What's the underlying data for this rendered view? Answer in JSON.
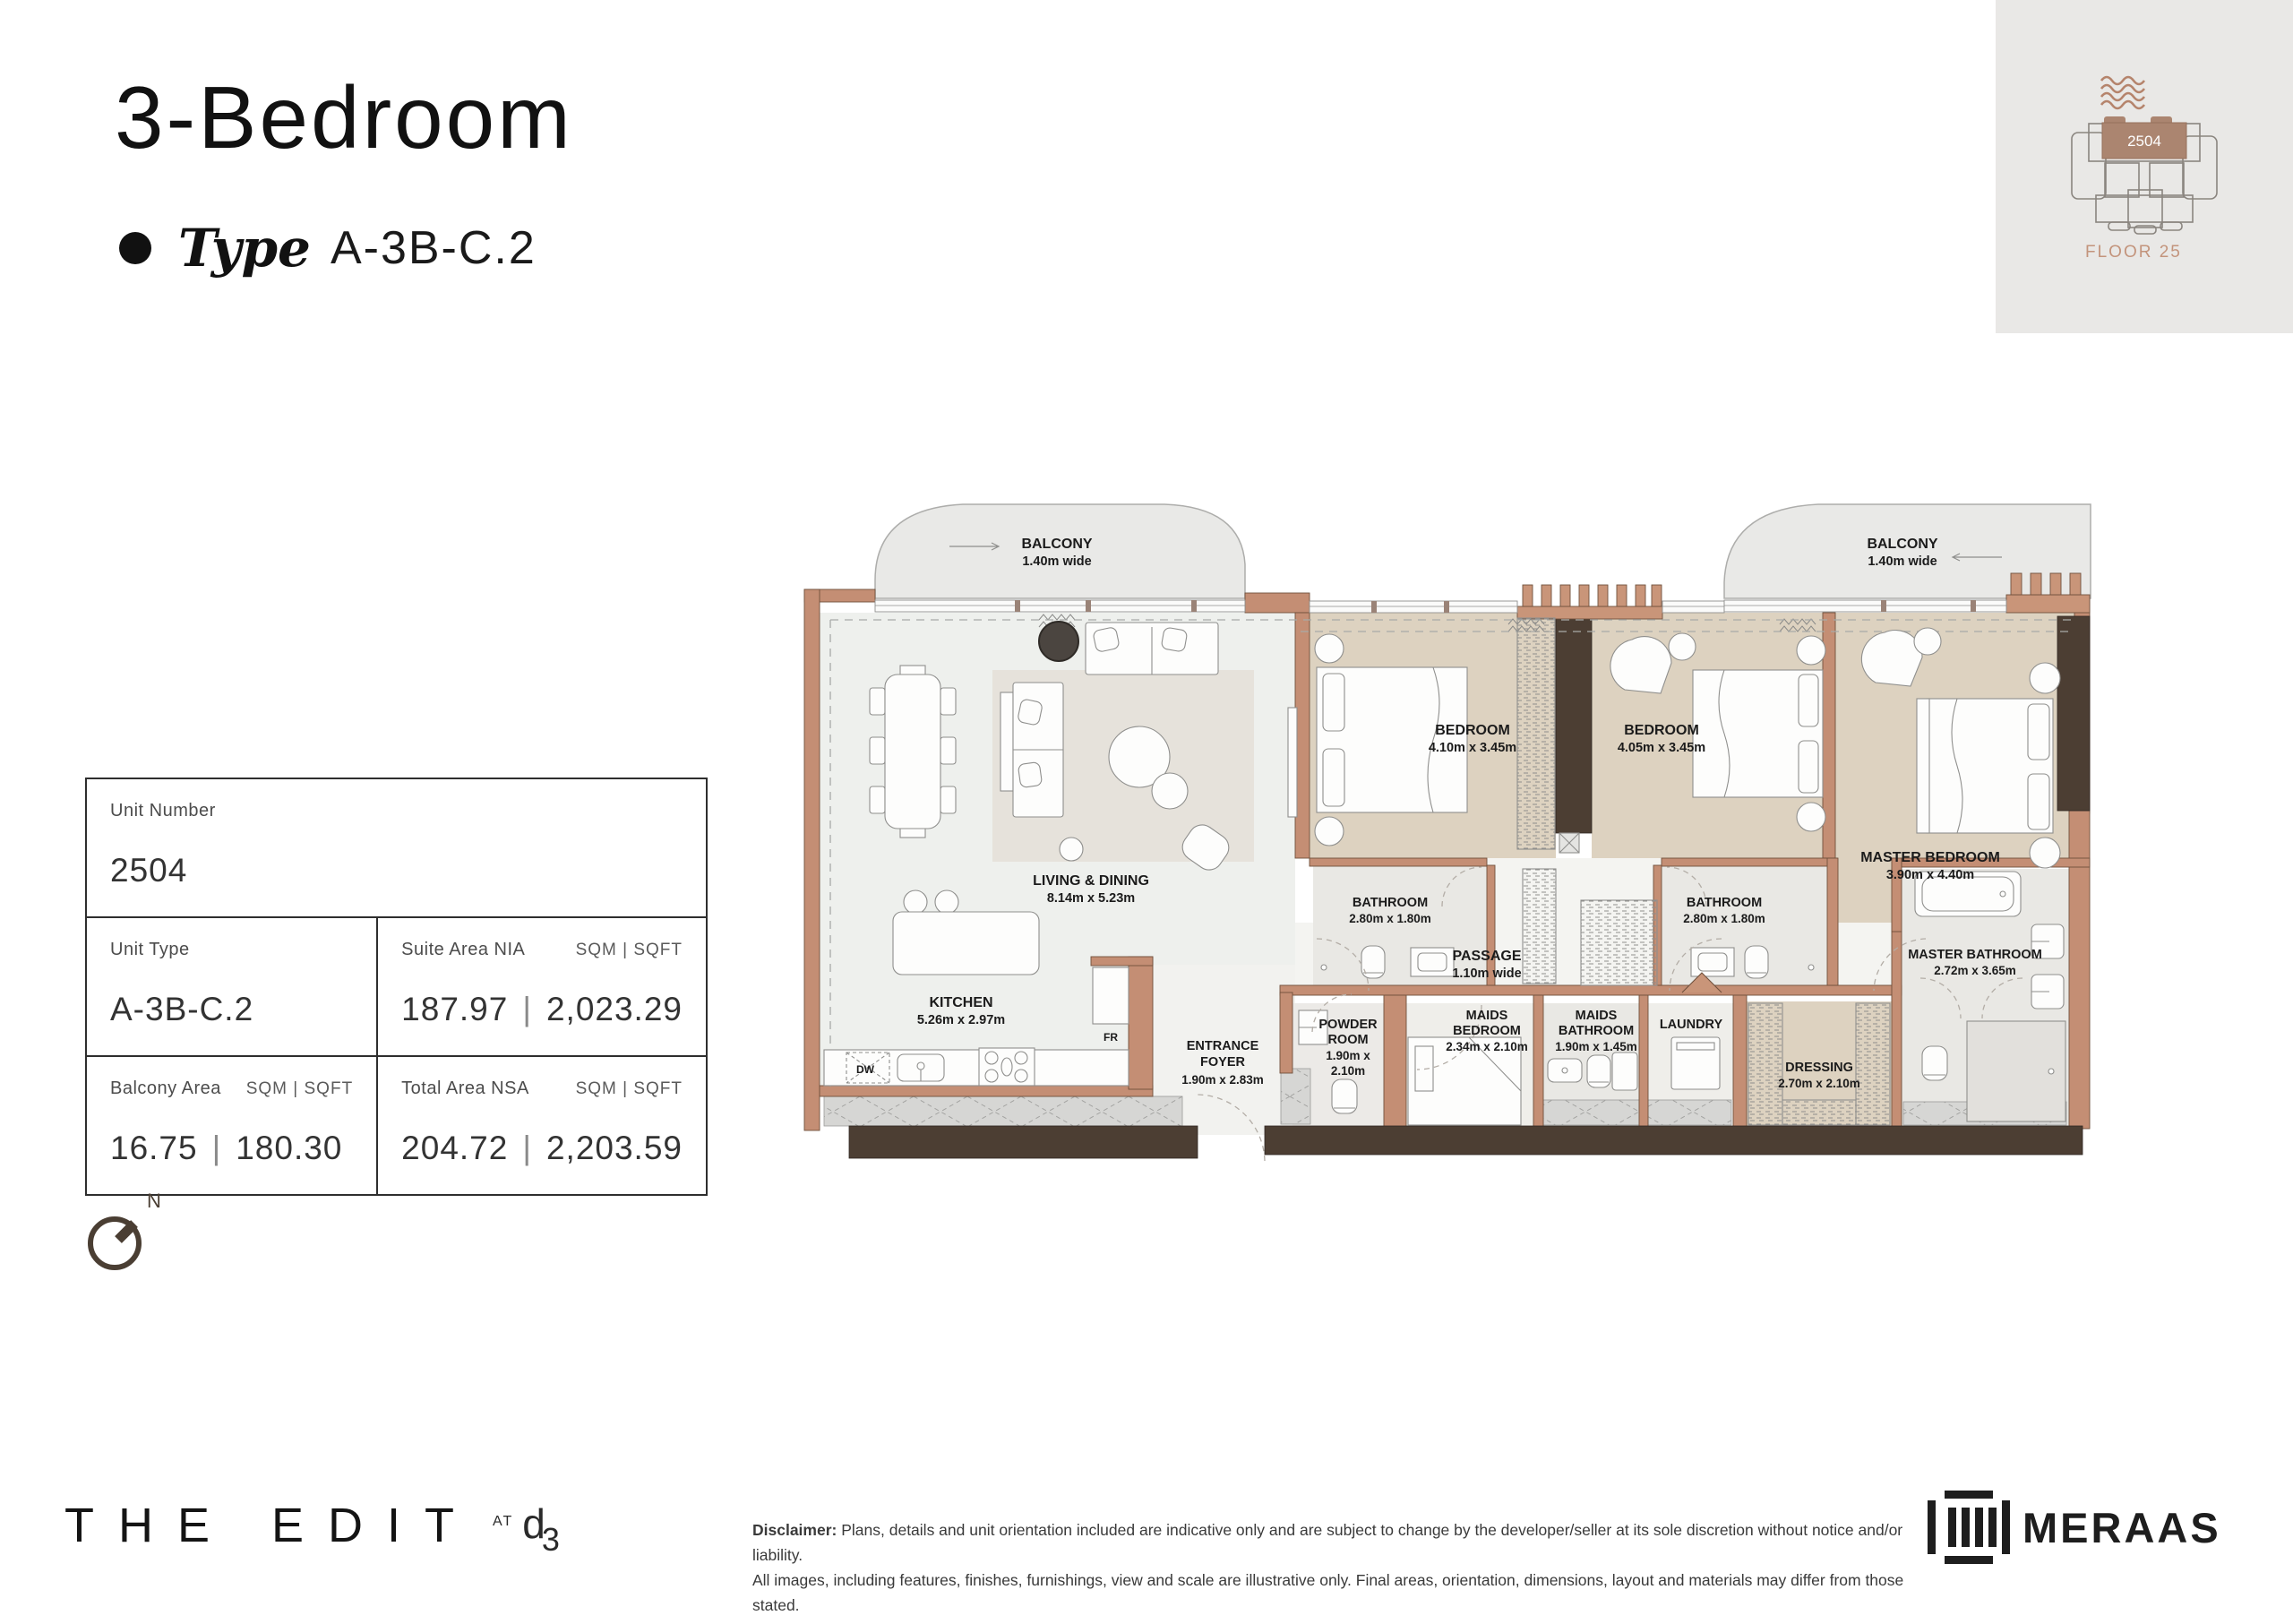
{
  "header": {
    "title": "3-Bedroom",
    "type_label": "Type",
    "type_value": "A-3B-C.2"
  },
  "locator": {
    "unit_number": "2504",
    "floor_label": "FLOOR 25"
  },
  "info_table": {
    "unit_number_label": "Unit Number",
    "unit_number": "2504",
    "unit_type_label": "Unit Type",
    "unit_type": "A-3B-C.2",
    "suite_label": "Suite Area NIA",
    "suite_units": "SQM | SQFT",
    "suite_sqm": "187.97",
    "suite_sqft": "2,023.29",
    "balcony_label": "Balcony Area",
    "balcony_units": "SQM | SQFT",
    "balcony_sqm": "16.75",
    "balcony_sqft": "180.30",
    "total_label": "Total Area NSA",
    "total_units": "SQM | SQFT",
    "total_sqm": "204.72",
    "total_sqft": "2,203.59",
    "pipe": "|"
  },
  "compass": {
    "north_label": "N"
  },
  "plan": {
    "balcony_left": {
      "l1": "BALCONY",
      "l2": "1.40m wide"
    },
    "balcony_right": {
      "l1": "BALCONY",
      "l2": "1.40m wide"
    },
    "living": {
      "l1": "LIVING & DINING",
      "l2": "8.14m x 5.23m"
    },
    "kitchen": {
      "l1": "KITCHEN",
      "l2": "5.26m x 2.97m"
    },
    "foyer": {
      "l1": "ENTRANCE",
      "l2": "FOYER",
      "l3": "1.90m x 2.83m"
    },
    "bedroom1": {
      "l1": "BEDROOM",
      "l2": "4.10m x 3.45m"
    },
    "bedroom2": {
      "l1": "BEDROOM",
      "l2": "4.05m x 3.45m"
    },
    "master_bedroom": {
      "l1": "MASTER BEDROOM",
      "l2": "3.90m x 4.40m"
    },
    "bathroom1": {
      "l1": "BATHROOM",
      "l2": "2.80m x 1.80m"
    },
    "bathroom2": {
      "l1": "BATHROOM",
      "l2": "2.80m x 1.80m"
    },
    "master_bathroom": {
      "l1": "MASTER BATHROOM",
      "l2": "2.72m x 3.65m"
    },
    "passage": {
      "l1": "PASSAGE",
      "l2": "1.10m wide"
    },
    "powder": {
      "l1": "POWDER",
      "l2": "ROOM",
      "l3": "1.90m x",
      "l4": "2.10m"
    },
    "maids_bedroom": {
      "l1": "MAIDS",
      "l2": "BEDROOM",
      "l3": "2.34m x 2.10m"
    },
    "maids_bathroom": {
      "l1": "MAIDS",
      "l2": "BATHROOM",
      "l3": "1.90m x 1.45m"
    },
    "laundry": {
      "l1": "LAUNDRY"
    },
    "dressing": {
      "l1": "DRESSING",
      "l2": "2.70m x 2.10m"
    },
    "fridge_marker": "FR",
    "dishwasher_marker": "DW"
  },
  "footer": {
    "brand": "THE EDIT",
    "brand_at": "AT",
    "brand_d": "d",
    "brand_3": "3",
    "disclaimer_label": "Disclaimer:",
    "disclaimer_line1": "Plans, details and unit orientation included are indicative only and are subject to change by the developer/seller at its sole discretion without notice and/or liability.",
    "disclaimer_line2": "All images, including features, finishes, furnishings, view and scale are illustrative only. Final areas, orientation, dimensions, layout and materials may differ from those stated.",
    "meraas": "MERAAS"
  },
  "colors": {
    "wall": "#c48e74",
    "wall_dark": "#4c3e33",
    "floor_beige": "#ddd2c0",
    "floor_light": "#eef0ed",
    "floor_bath": "#e9e8e4",
    "balcony": "#e9e9e7",
    "accent_brown": "#b5846c",
    "floor_text": "#c3947c"
  }
}
